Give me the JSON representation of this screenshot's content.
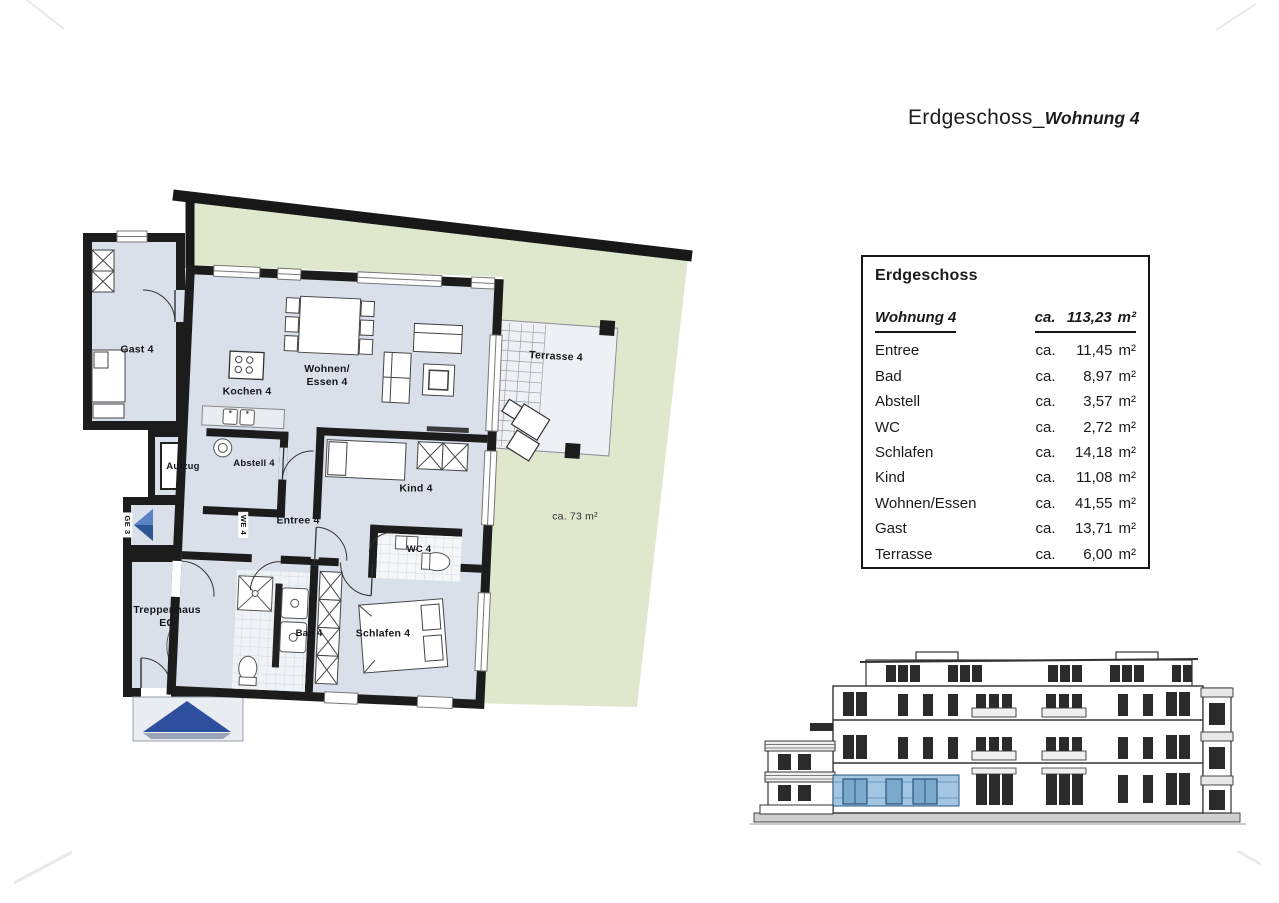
{
  "page": {
    "title_prefix": "Erdgeschoss_",
    "title_suffix": "Wohnung 4"
  },
  "area_table": {
    "header": "Erdgeschoss",
    "prefix": "ca.",
    "unit": "m²",
    "total": {
      "label": "Wohnung 4",
      "value": "113,23"
    },
    "rows": [
      {
        "label": "Entree",
        "value": "11,45"
      },
      {
        "label": "Bad",
        "value": "8,97"
      },
      {
        "label": "Abstell",
        "value": "3,57"
      },
      {
        "label": "WC",
        "value": "2,72"
      },
      {
        "label": "Schlafen",
        "value": "14,18"
      },
      {
        "label": "Kind",
        "value": "11,08"
      },
      {
        "label": "Wohnen/Essen",
        "value": "41,55"
      },
      {
        "label": "Gast",
        "value": "13,71"
      },
      {
        "label": "Terrasse",
        "value": "6,00"
      }
    ]
  },
  "plan": {
    "labels": {
      "gast": "Gast 4",
      "wohnen_essen": "Wohnen/\nEssen 4",
      "kochen": "Kochen 4",
      "aufzug": "Aufzug",
      "abstell": "Abstell 4",
      "entree": "Entree 4",
      "kind": "Kind 4",
      "wc": "WC 4",
      "treppenhaus": "Treppenhaus\nEG",
      "bad": "Bad 4",
      "schlafen": "Schlafen 4",
      "terrasse": "Terrasse 4",
      "garden_area": "ca. 73 m²",
      "unit_marker_left": "GE 3",
      "unit_marker_right": "WE 4"
    },
    "colors": {
      "floor": "#d9e0ea",
      "garden": "#dfe7cc",
      "wall": "#1c1c1c",
      "terrace": "#edf0f4",
      "arrow_blue": "#2c5593",
      "arrow_blue_light": "#5a82c4",
      "canopy_blue": "#2e4f9d",
      "elevation_glazing": "#a3c6e2"
    }
  }
}
